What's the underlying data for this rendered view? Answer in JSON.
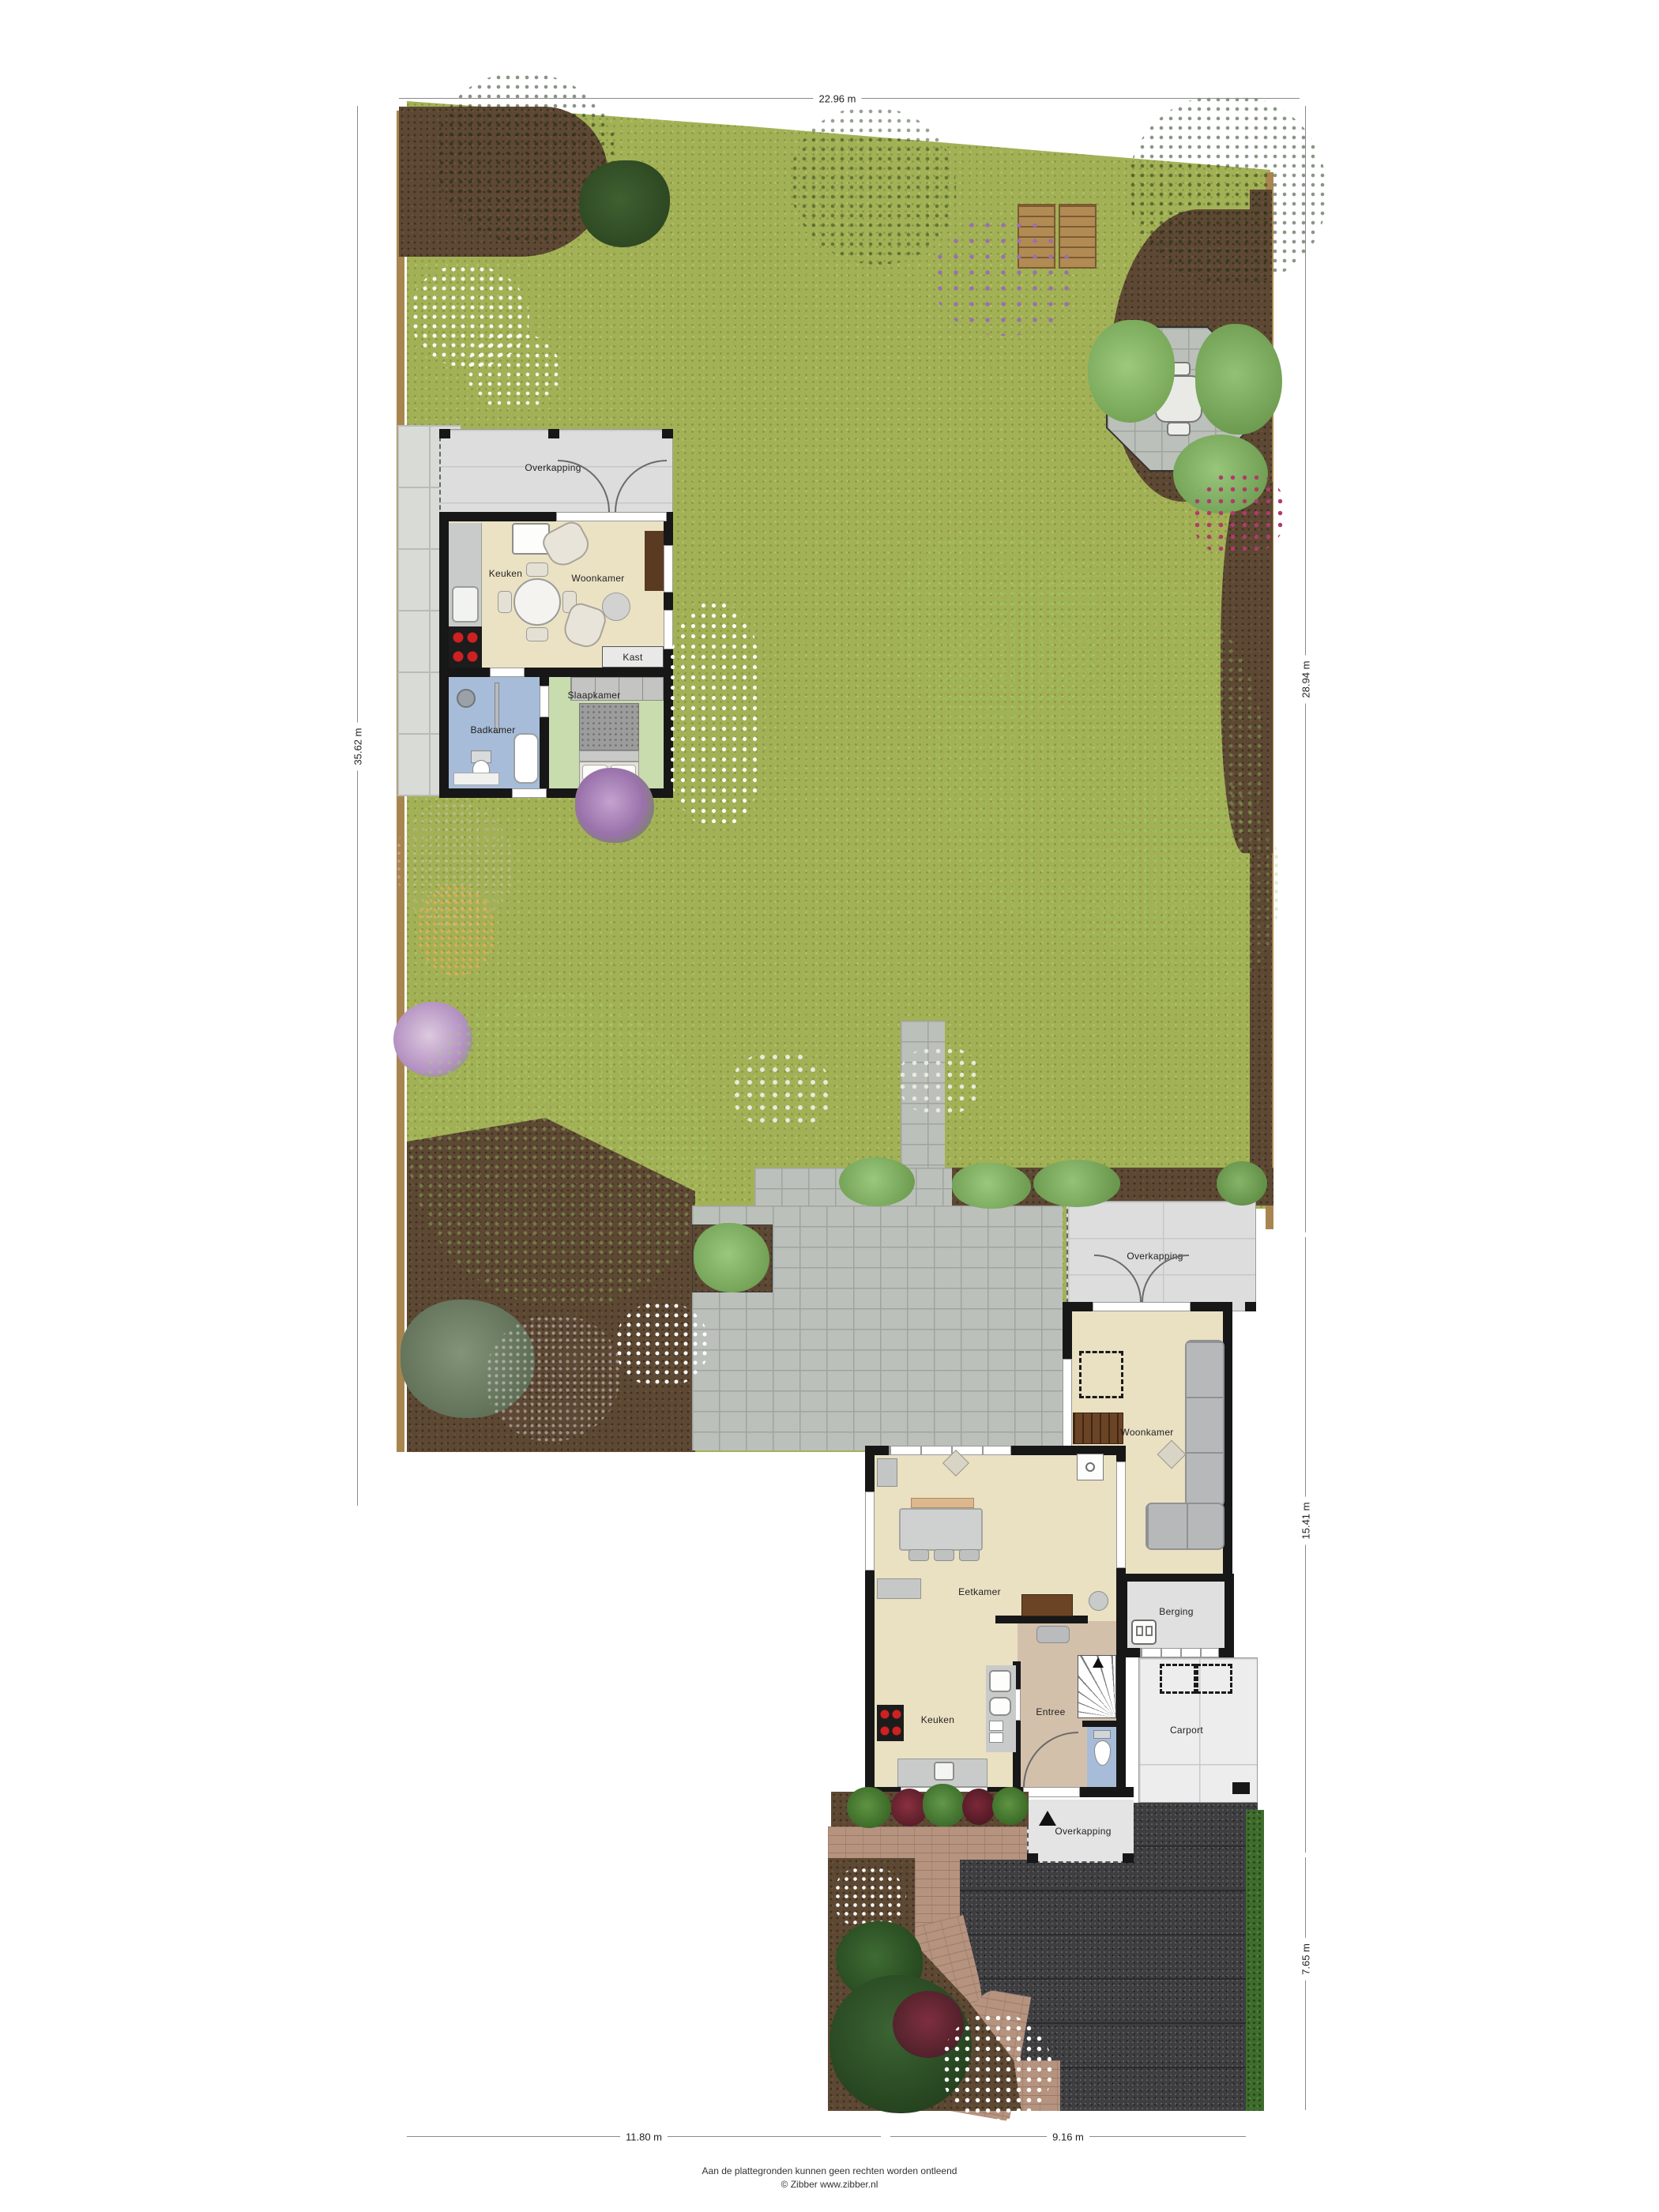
{
  "plan": {
    "dimensions": {
      "top": "22.96 m",
      "left": "35.62 m",
      "right_upper": "28.94 m",
      "right_middle": "15.41 m",
      "right_lower": "7.65 m",
      "bottom_left": "11.80 m",
      "bottom_right": "9.16 m"
    },
    "guest_house": {
      "overkapping": "Overkapping",
      "keuken": "Keuken",
      "woonkamer": "Woonkamer",
      "kast": "Kast",
      "badkamer": "Badkamer",
      "slaapkamer": "Slaapkamer"
    },
    "main_house": {
      "overkapping_top": "Overkapping",
      "woonkamer": "Woonkamer",
      "eetkamer": "Eetkamer",
      "berging": "Berging",
      "keuken": "Keuken",
      "entree": "Entree",
      "carport": "Carport",
      "overkapping_bottom": "Overkapping"
    },
    "footer": {
      "line1": "Aan de plattegronden kunnen geen rechten worden ontleend",
      "line2": "© Zibber www.zibber.nl"
    },
    "colors": {
      "grass": "#a3b156",
      "soil": "#5d4833",
      "paver": "#bcc0bb",
      "asphalt": "#3e3e41",
      "brick_path": "#b5937f",
      "hedge": "#3f6d2d",
      "floor_main": "#eae0c2",
      "floor_entree": "#d3c0ab",
      "floor_bath": "#a7bcd8",
      "floor_bedroom": "#c9dcae",
      "canopy": "#dcdddc",
      "wall": "#171717"
    }
  }
}
